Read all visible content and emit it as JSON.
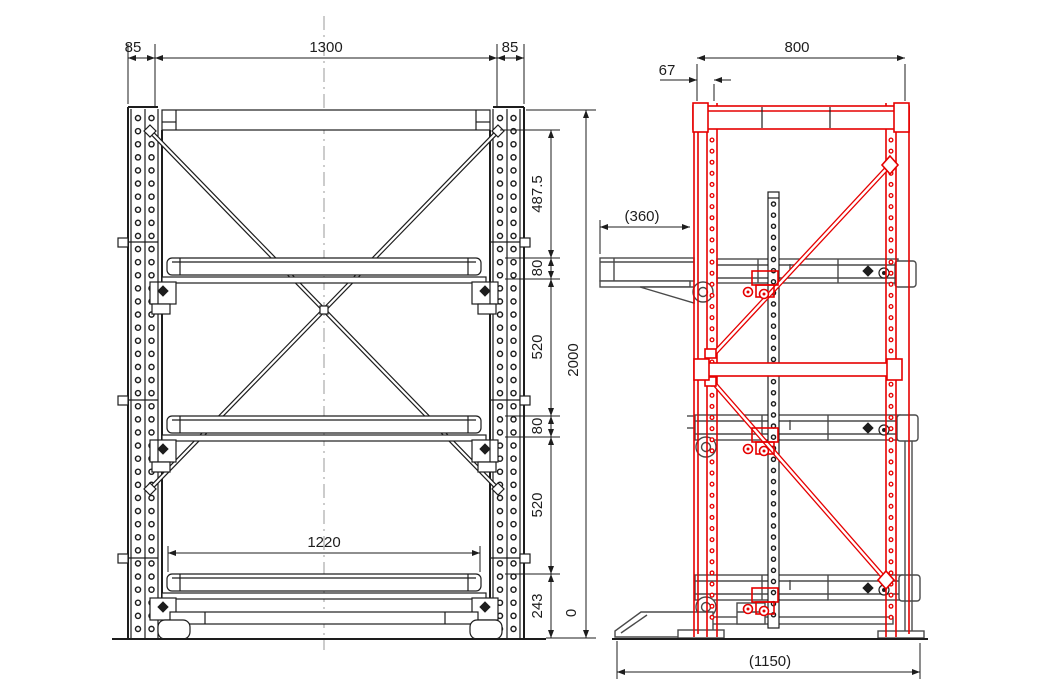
{
  "drawing": {
    "front_view": {
      "top_dims": {
        "left": "85",
        "center": "1300",
        "right": "85"
      },
      "height_chain": [
        "487.5",
        "80",
        "520",
        "80",
        "520",
        "243"
      ],
      "overall_height": "2000",
      "datum": "0",
      "clear_width": "1220"
    },
    "side_view": {
      "overall_width": "800",
      "column_offset": "67",
      "arm_overhang": "(360)",
      "overall_depth": "(1150)"
    }
  },
  "colors": {
    "frame_red": "#e60000",
    "line_dark": "#1d1d1d",
    "line_gray": "#4a4a4a",
    "centerline_gray": "#999999"
  }
}
